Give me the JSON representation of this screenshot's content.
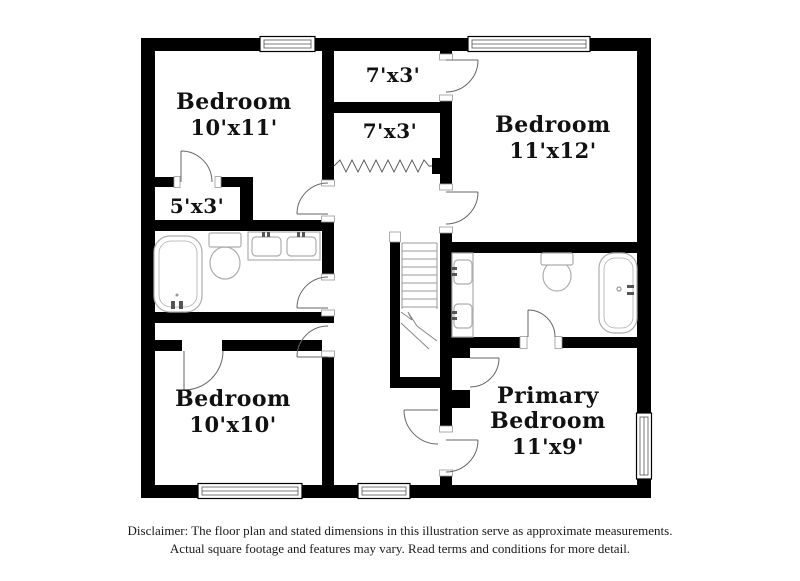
{
  "floor_plan": {
    "rooms": [
      {
        "id": "bedroom-top-left",
        "name": "Bedroom",
        "dims": "10'x11'"
      },
      {
        "id": "closet-top",
        "dims": "7'x3'"
      },
      {
        "id": "closet-mid",
        "dims": "7'x3'"
      },
      {
        "id": "bedroom-top-right",
        "name": "Bedroom",
        "dims": "11'x12'"
      },
      {
        "id": "closet-left",
        "dims": "5'x3'"
      },
      {
        "id": "bedroom-bottom-left",
        "name": "Bedroom",
        "dims": "10'x10'"
      },
      {
        "id": "primary-bedroom",
        "name_line1": "Primary",
        "name_line2": "Bedroom",
        "dims": "11'x9'"
      }
    ],
    "fixtures": [
      "bathtub-left",
      "toilet-left",
      "double-vanity-sinks",
      "staircase",
      "vanity-sinks-right",
      "toilet-right",
      "bathtub-right",
      "accordion-closet-door"
    ],
    "disclaimer_line1": "Disclaimer: The floor plan and stated dimensions in this illustration serve as approximate measurements.",
    "disclaimer_line2": "Actual square footage and features may vary. Read terms and conditions for more detail.",
    "colors": {
      "wall": "#000000",
      "background": "#ffffff",
      "fixture_line": "#adadad",
      "door_line": "#666666",
      "stair_line": "#999999",
      "text": "#111111"
    }
  }
}
